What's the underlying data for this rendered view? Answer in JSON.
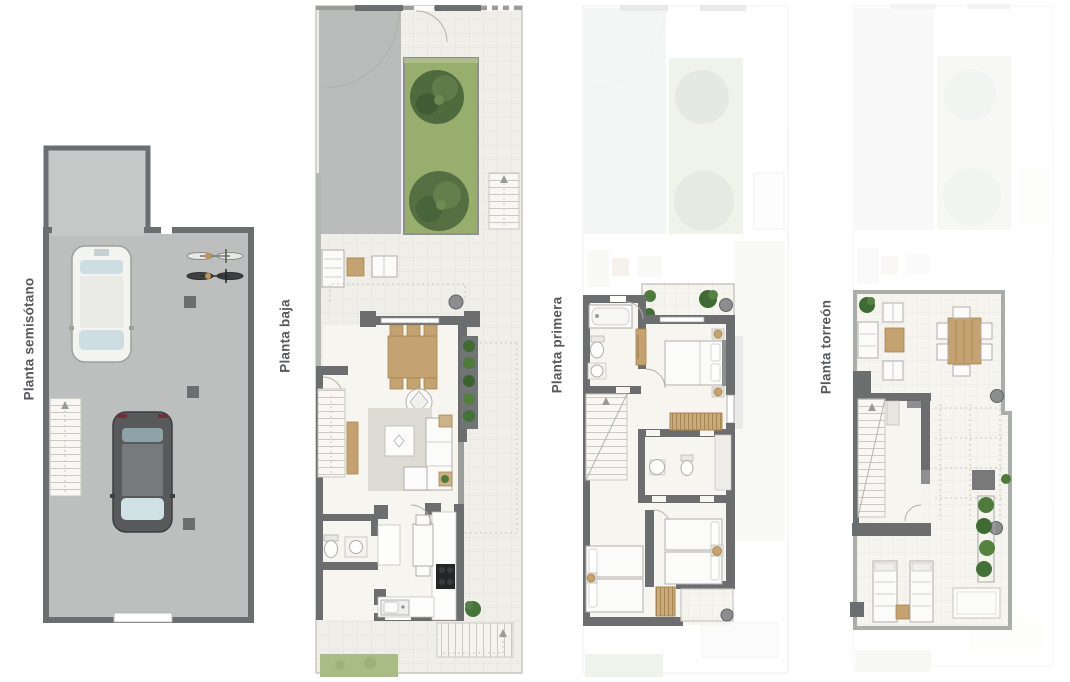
{
  "sheet": {
    "background": "#ffffff",
    "type": "residential floor plan sheet, four levels"
  },
  "plans": [
    {
      "id": "planta-semisotano",
      "label": "Planta semisótano",
      "depicts": [
        "garage floor",
        "entry ramp",
        "white car",
        "dark car",
        "two bicycles",
        "staircase",
        "structural pillars",
        "garage door"
      ]
    },
    {
      "id": "planta-baja",
      "label": "Planta baja",
      "depicts": [
        "driveway with gate arc",
        "garden with two trees",
        "entrance stair",
        "porch seating",
        "living-dining room",
        "dining table with six chairs",
        "sofa with rug and coffee table",
        "wall planters",
        "guest wc",
        "kitchen with cooktop and sink",
        "interior staircase",
        "exterior rear stair",
        "lawn strip"
      ]
    },
    {
      "id": "planta-primera",
      "label": "Planta primera",
      "depicts": [
        "ghosted ground floor",
        "balcony terrace with plants",
        "bathroom with bathtub",
        "master bedroom with double bed",
        "wardrobes",
        "second bathroom",
        "two twin bedrooms",
        "staircase",
        "rear terrace"
      ]
    },
    {
      "id": "planta-torreon",
      "label": "Planta torreón",
      "depicts": [
        "ghosted lower floor",
        "roof terrace",
        "outdoor lounge set",
        "outdoor dining table with six chairs",
        "staircase enclosure",
        "pergola grid",
        "planter with shrubs",
        "two sun loungers",
        "side table"
      ]
    }
  ],
  "colors": {
    "wall": "#6b6d6e",
    "wall-light": "#9b9d9a",
    "garage-floor": "#bdbfbe",
    "ramp": "#c6c8c7",
    "driveway": "#b9bbba",
    "interior": "#f6f5f0",
    "grass": "#98ae6e",
    "tree": "#4f6b3e",
    "wood": "#c4a271",
    "wood-dark": "#a8854f",
    "plant": "#4e7a3c",
    "post": "#8b8d8e",
    "label-text": "#58595b"
  }
}
